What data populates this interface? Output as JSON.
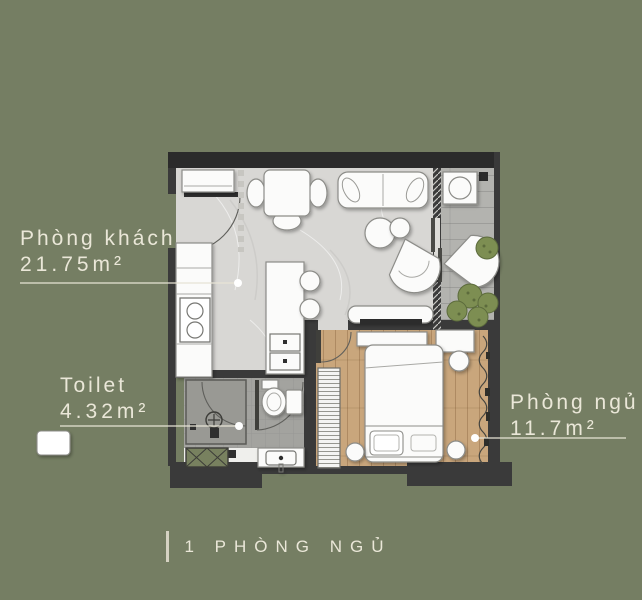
{
  "title": {
    "text": "1 PHÒNG NGỦ"
  },
  "labels": {
    "living": {
      "name": "Phòng khách",
      "area": "21.75m²"
    },
    "toilet": {
      "name": "Toilet",
      "area": "4.32m²"
    },
    "bedroom": {
      "name": "Phòng ngủ",
      "area": "11.7m²"
    }
  },
  "colors": {
    "bg": "#757e63",
    "label_text": "#eae7d8",
    "leader": "#e7e4d5",
    "wall": "#3a3a3a",
    "wall_dark": "#2b2b2b",
    "living_floor": "#d8d7d4",
    "bedroom_floor": "#c9a67c",
    "toilet_floor": "#a3a39f",
    "shower_floor": "#999994",
    "balcony_floor": "#b3b3af",
    "furniture": "#fbfbfa",
    "furniture_stroke": "#8c8c88",
    "plant": "#7d8e52",
    "shaft": "#78815f",
    "tv": "#2c2c2c"
  }
}
